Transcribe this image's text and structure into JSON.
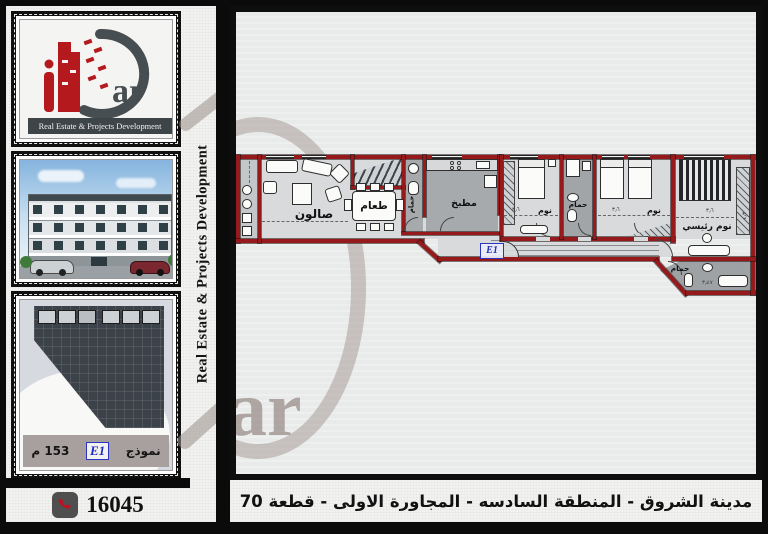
{
  "brand": {
    "logo_latin": "ar",
    "tagline": "Real Estate & Projects Development",
    "colors": {
      "accent_red": "#b3191d",
      "dark_slate": "#3d4548",
      "watermark_taupe": "#9a8f8b",
      "wall_red": "#96191c",
      "unit_blue": "#1f2bbf"
    }
  },
  "sidebar": {
    "model_caption": {
      "model_word": "نموذج",
      "code": "E1",
      "area": "153 م"
    }
  },
  "main": {
    "watermark_text": "ar",
    "floor_plan": {
      "unit_label": "E1",
      "rooms": [
        {
          "label": "صالون"
        },
        {
          "label": "طعام"
        },
        {
          "label": "مطبخ"
        },
        {
          "label": "حمام"
        },
        {
          "label": "نوم"
        },
        {
          "label": "حمام"
        },
        {
          "label": "نوم"
        },
        {
          "label": "نوم رئيسي"
        },
        {
          "label": "حمام"
        }
      ],
      "dimensions": [
        "٣٫٦",
        "٣٫٦",
        "٣٫٦",
        "٤٫٣",
        "٣٫٤٧"
      ]
    }
  },
  "footer": {
    "phone": "16045",
    "address": "مدينة الشروق - المنطقة السادسه - المجاورة الاولى - قطعة 70"
  }
}
